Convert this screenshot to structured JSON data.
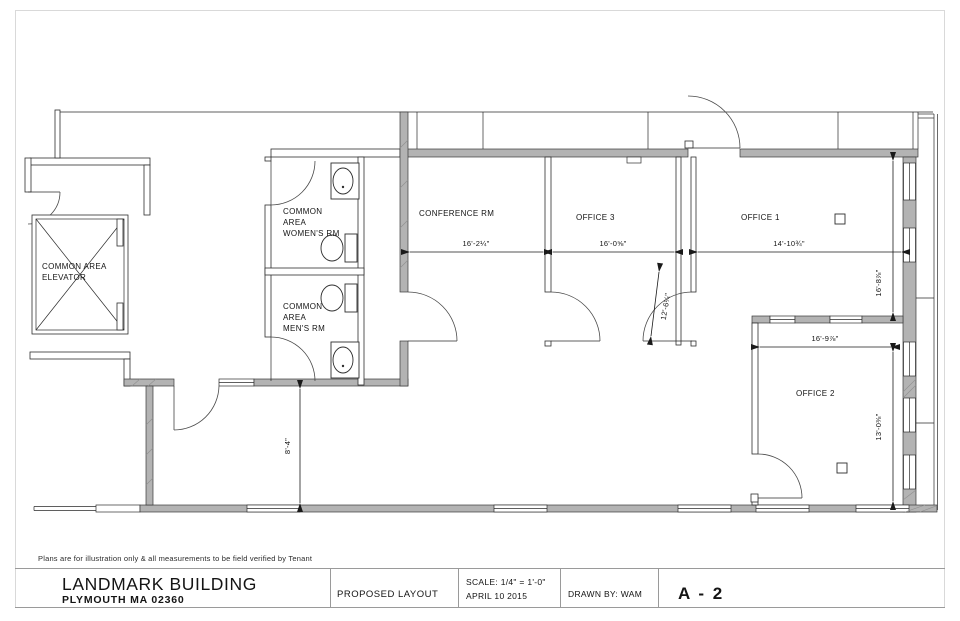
{
  "plan": {
    "rooms": {
      "elevator": {
        "label_line1": "COMMON AREA",
        "label_line2": "ELEVATOR"
      },
      "womens": {
        "label_line1": "COMMON",
        "label_line2": "AREA",
        "label_line3": "WOMEN'S RM"
      },
      "mens": {
        "label_line1": "COMMON",
        "label_line2": "AREA",
        "label_line3": "MEN'S RM"
      },
      "conference": {
        "label": "CONFERENCE RM",
        "width_dim": "16'-2¼\""
      },
      "office3": {
        "label": "OFFICE 3",
        "width_dim": "16'-0⅝\""
      },
      "office1": {
        "label": "OFFICE 1",
        "width_dim": "14'-10¾\"",
        "depth_dim": "16'-8⅞\""
      },
      "office2": {
        "label": "OFFICE 2",
        "width_dim": "16'-9⅞\"",
        "depth_dim": "13'-0⅜\""
      }
    },
    "dimensions": {
      "door_diagonal": "12'-6¼\"",
      "corridor_depth": "8'-4\""
    }
  },
  "disclaimer": "Plans are for illustration only & all measurements to be field verified by Tenant",
  "title_block": {
    "building_name": "LANDMARK BUILDING",
    "address": "PLYMOUTH MA 02360",
    "drawing_title": "PROPOSED LAYOUT",
    "scale_label": "SCALE:   1/4\" = 1'-0\"",
    "date": "APRIL 10 2015",
    "drawn_by": "DRAWN BY:   WAM",
    "sheet_number": "A - 2"
  },
  "colors": {
    "address_blue": "#3f97cf",
    "wall_gray": "#b3b3b3"
  }
}
